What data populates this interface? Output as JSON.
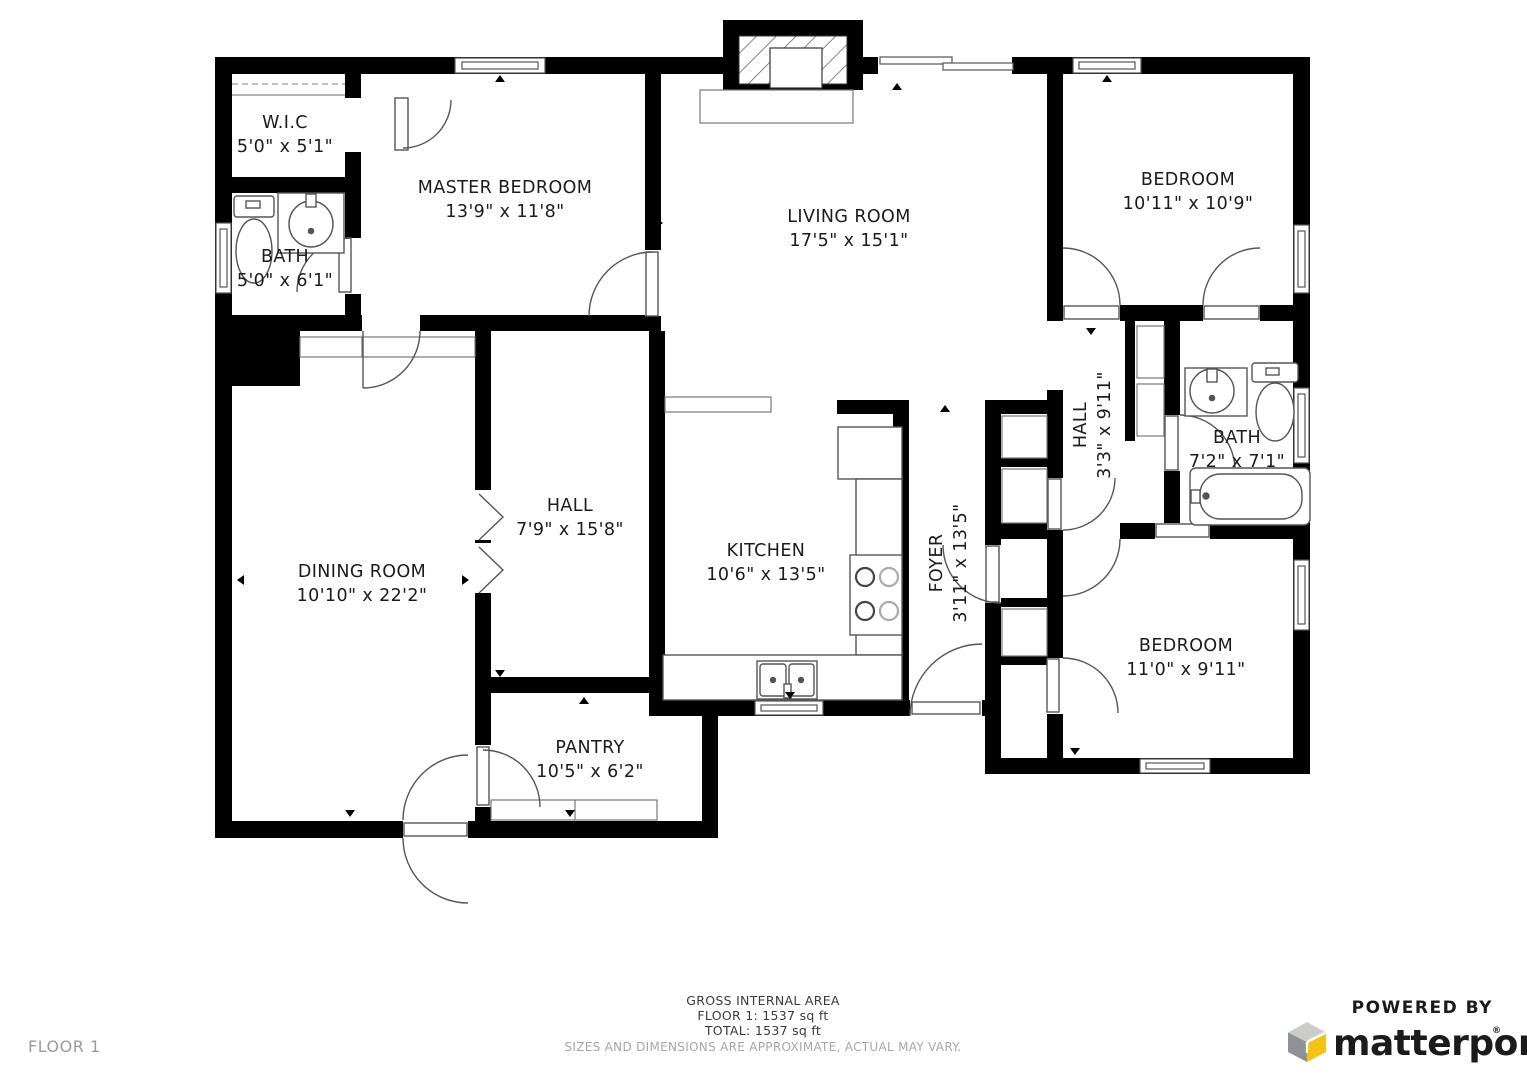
{
  "floor_label": "FLOOR 1",
  "rooms": [
    {
      "name": "W.I.C",
      "dims": "5'0\" x 5'1\""
    },
    {
      "name": "BATH",
      "dims": "5'0\" x 6'1\""
    },
    {
      "name": "MASTER BEDROOM",
      "dims": "13'9\" x 11'8\""
    },
    {
      "name": "LIVING ROOM",
      "dims": "17'5\" x 15'1\""
    },
    {
      "name": "BEDROOM",
      "dims": "10'11\" x 10'9\""
    },
    {
      "name": "HALL",
      "dims": "3'3\" x 9'11\""
    },
    {
      "name": "BATH",
      "dims": "7'2\" x 7'1\""
    },
    {
      "name": "HALL",
      "dims": "7'9\" x 15'8\""
    },
    {
      "name": "DINING ROOM",
      "dims": "10'10\" x 22'2\""
    },
    {
      "name": "KITCHEN",
      "dims": "10'6\" x 13'5\""
    },
    {
      "name": "FOYER",
      "dims": "3'11\" x 13'5\""
    },
    {
      "name": "BEDROOM",
      "dims": "11'0\" x 9'11\""
    },
    {
      "name": "PANTRY",
      "dims": "10'5\" x 6'2\""
    }
  ],
  "footer": {
    "area_title": "GROSS INTERNAL AREA",
    "floor_area": "FLOOR 1: 1537 sq ft",
    "total_area": "TOTAL: 1537 sq ft",
    "disclaimer": "SIZES AND DIMENSIONS ARE APPROXIMATE, ACTUAL MAY VARY."
  },
  "branding": {
    "powered_by": "POWERED BY",
    "brand": "matterport",
    "registered": "®"
  },
  "colors": {
    "wall": "#000000",
    "fixture_line": "#555555",
    "muted_text": "#9a9a9a",
    "brand_navy": "#1d3d5d",
    "cube_yellow": "#f5c112",
    "cube_gray": "#8f9294",
    "cube_light": "#cccdcb"
  }
}
